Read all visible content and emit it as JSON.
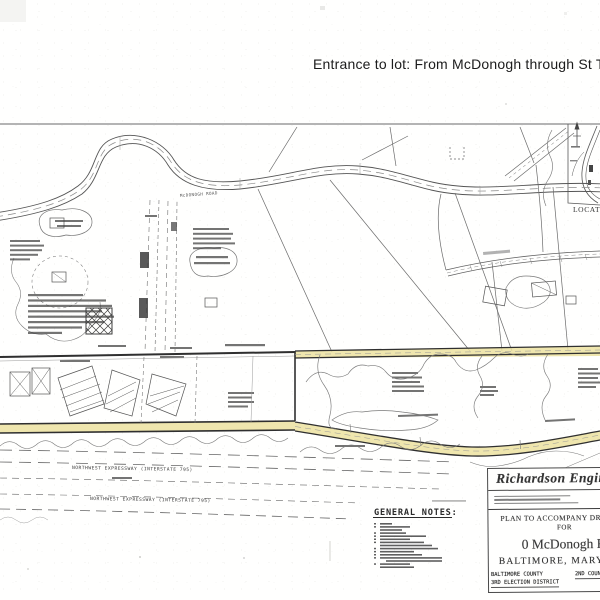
{
  "annotation": {
    "text": "Entrance to lot: From McDonogh through St Timothy"
  },
  "plan": {
    "road_label": "McDONOGH ROAD",
    "expressway_upper": "NORTHWEST EXPRESSWAY (INTERSTATE 795)",
    "expressway_lower": "NORTHWEST EXPRESSWAY (INTERSTATE 795)",
    "location_map_label": "LOCATION MAP",
    "notes_heading": "GENERAL NOTES:"
  },
  "title_block": {
    "firm": "Richardson Engineering",
    "plan_title": "PLAN TO ACCOMPANY DRC",
    "for_label": "FOR",
    "project": "0 McDonogh Road",
    "city": "BALTIMORE, MARYLAND",
    "county": "BALTIMORE COUNTY",
    "district": "3RD ELECTION DISTRICT",
    "council": "2ND COUNCIL DISTRICT"
  }
}
